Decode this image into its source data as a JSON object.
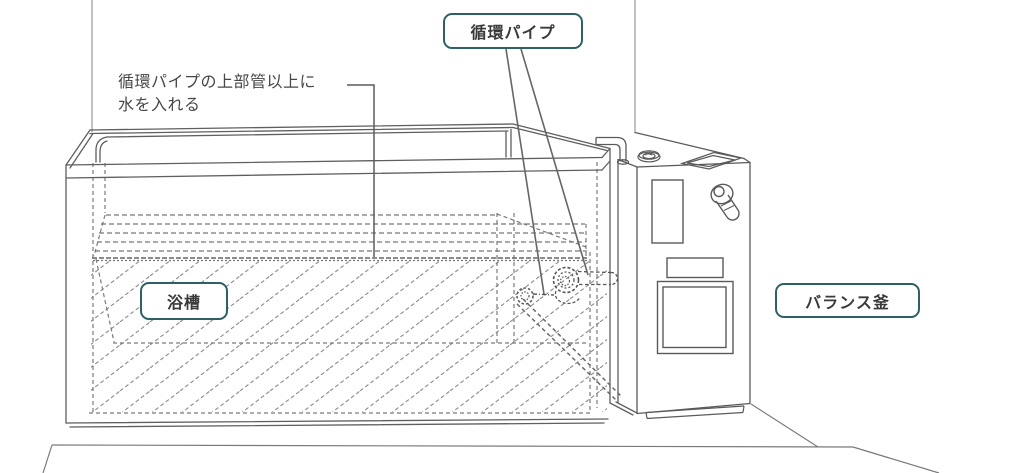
{
  "labels": {
    "circulation_pipe": "循環パイプ",
    "bathtub": "浴槽",
    "balance_boiler": "バランス釜"
  },
  "annotation": {
    "line1": "循環パイプの上部管以上に",
    "line2": "水を入れる"
  },
  "colors": {
    "accent": "#2e6166",
    "text": "#3a3a3a",
    "annotation": "#474747",
    "background": "#ffffff",
    "solid_line": "#5f5f5f",
    "hidden_line": "#7a7a7a",
    "hatch_line": "#8a8a8a"
  }
}
